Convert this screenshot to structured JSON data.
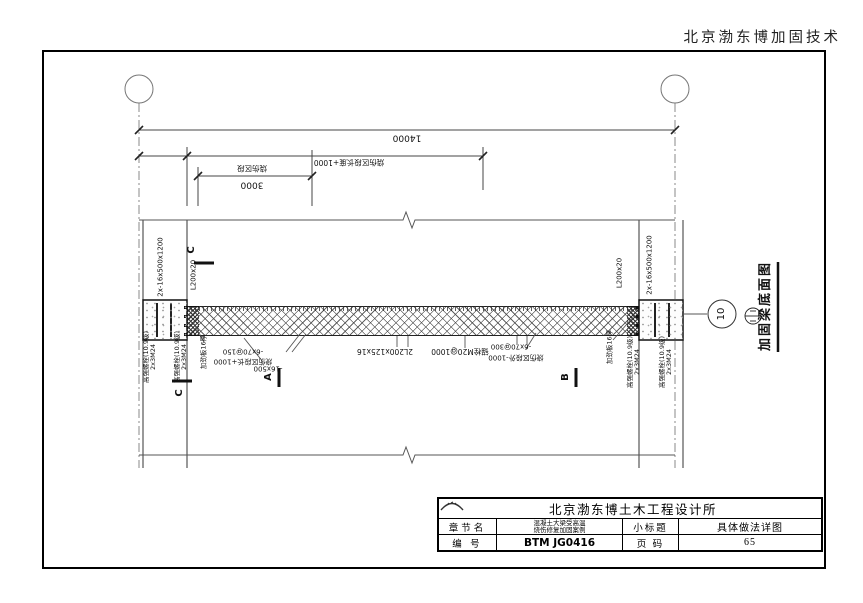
{
  "page": {
    "company_header": "北京渤东博加固技术"
  },
  "drawing": {
    "title": "加固梁底面图",
    "grid_bubble_label": "10",
    "dims": {
      "overall": "14000",
      "zone_plus_1000": "烧伤区段长度+1000",
      "zone_name": "烧伤区段",
      "zone_len": "3000"
    },
    "labels": {
      "angle_pair": "2x-16x500x1200",
      "end_angle": "L200x20",
      "hs_bolt": "高强螺栓(10.9级)",
      "hs_bolt_qty": "2x3M24",
      "stiffener": "加劲板16厚",
      "strap_150": "-6x70@150",
      "strap_150_note": "烧伤区段长+1000",
      "bottom_plate": "-16x500",
      "channels": "2L200x125x16",
      "anchor_bolt": "锚栓M20@1000",
      "strap_300": "-6x70@300",
      "strap_300_note": "烧伤区段外-1000"
    },
    "sections": {
      "a": "A",
      "b": "B",
      "c": "C"
    }
  },
  "title_block": {
    "firm": "北京渤东博土木工程设计所",
    "chapter_label": "章节名",
    "chapter_line1": "混凝土大梁受高温",
    "chapter_line2": "烧伤修复加固案例",
    "subtitle_label": "小标题",
    "subtitle": "具体做法详图",
    "number_label": "编 号",
    "number": "BTM JG0416",
    "page_label": "页 码",
    "page": "65"
  }
}
